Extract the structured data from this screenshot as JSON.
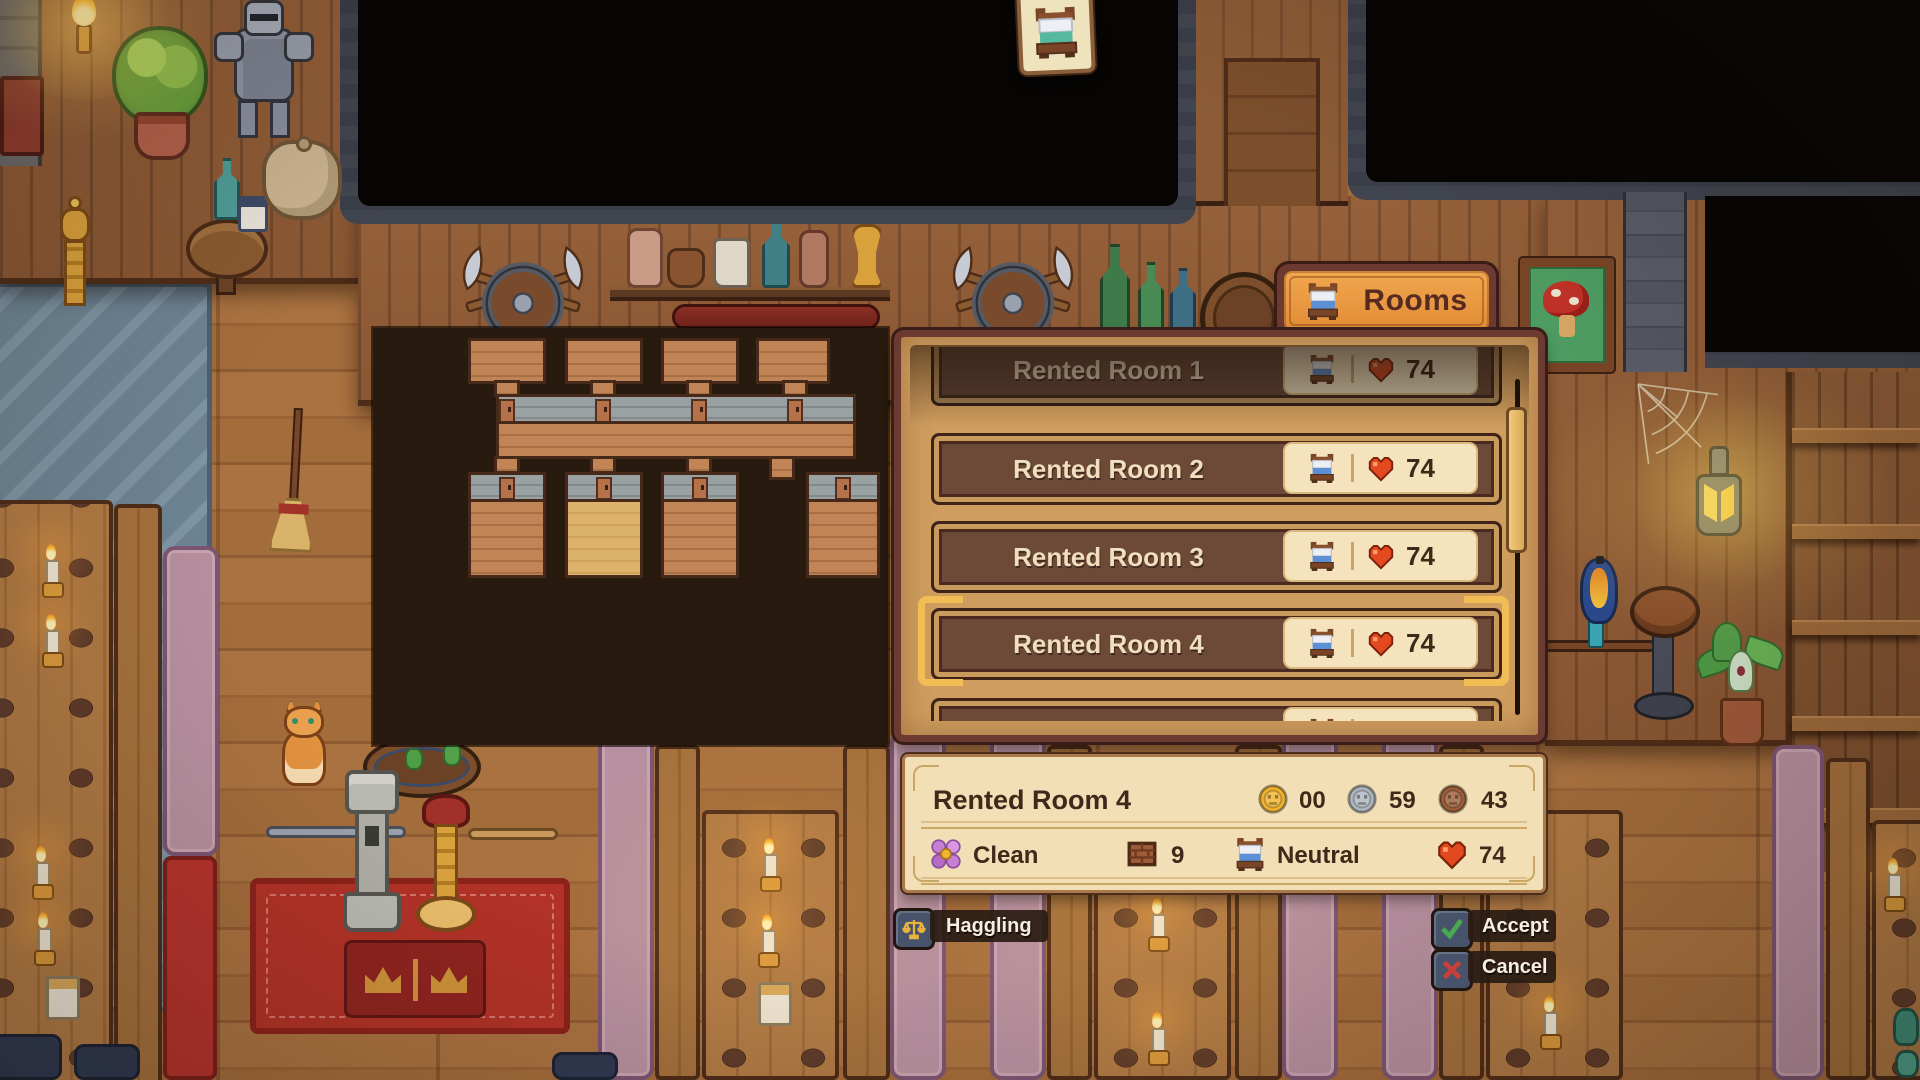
{
  "hud": {
    "rooms_tab": {
      "label": "Rooms",
      "icon": "bed-icon"
    },
    "hanging_sign": {
      "icon": "bed-icon"
    }
  },
  "room_list": {
    "rooms": [
      {
        "name": "Rented Room 1",
        "rating": "74",
        "state": "dimmed"
      },
      {
        "name": "Rented Room 2",
        "rating": "74",
        "state": "normal"
      },
      {
        "name": "Rented Room 3",
        "rating": "74",
        "state": "normal"
      },
      {
        "name": "Rented Room 4",
        "rating": "74",
        "state": "selected"
      },
      {
        "name": "Rented Room 5",
        "rating": "76",
        "state": "normal"
      }
    ]
  },
  "room_detail": {
    "title": "Rented Room 4",
    "price": {
      "gold": "00",
      "silver": "59",
      "copper": "43"
    },
    "stats": {
      "cleanliness": "Clean",
      "size": "9",
      "tenant_mood": "Neutral",
      "rating": "74"
    }
  },
  "actions": {
    "haggling": "Haggling",
    "accept": "Accept",
    "cancel": "Cancel"
  },
  "colors": {
    "selection_gold": "#f3bd55",
    "heart_red": "#e2491f",
    "panel_tan": "#cf9d5e",
    "row_brown": "#6d4938",
    "tab_orange": "#ec9b45",
    "coin_gold": "#f2b42d",
    "coin_silver": "#aeb6bf",
    "coin_copper": "#9d5f3a",
    "highlight_floor": "#ddb26a"
  }
}
